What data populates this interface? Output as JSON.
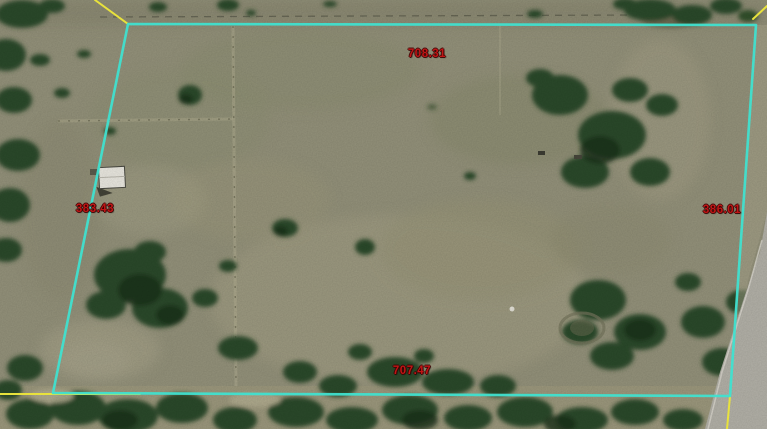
{
  "map": {
    "dimension_labels": {
      "top": "708.31",
      "bottom": "707.47",
      "left": "383.43",
      "right": "386.01"
    }
  },
  "colors": {
    "parcel_boundary": "#3fe0cf",
    "survey_line": "#e8e23c",
    "dimension_text": "#c01616"
  }
}
